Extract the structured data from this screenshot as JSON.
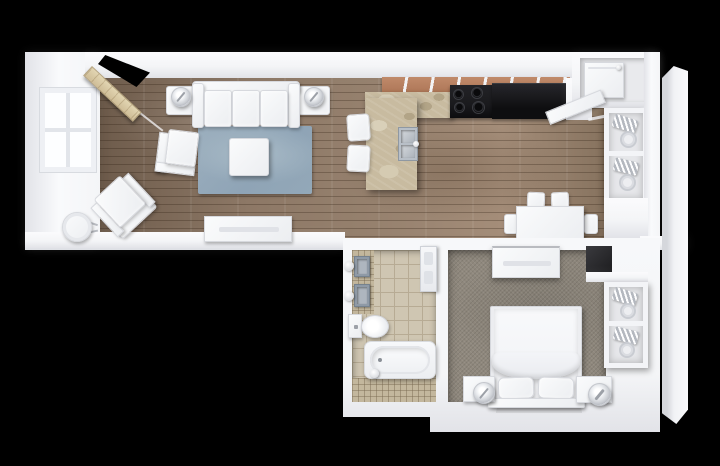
{
  "scene": {
    "type": "floor_plan_3d_render",
    "view": "top_down",
    "subject": "one-bedroom apartment with open living/kitchen/dining area, bathroom and bedroom",
    "background_color": "#000000"
  },
  "colors": {
    "background": "#000000",
    "wall": "#f4f5f7",
    "wall_shade": "#e2e3e8",
    "wood": "#8d7866",
    "wood_dark": "#6d5b4b",
    "wood_light": "#a48d79",
    "rug_blue": "#8fa4b6",
    "rug_blue_light": "#a9bbc7",
    "carpet": "#8f887d",
    "tile": "#cfc6b2",
    "grout": "#b7ab94",
    "mosaic": "#c3b79d",
    "granite": "#c8bba0",
    "granite_dark": "#b2a487",
    "cabinet_wood": "#b27b5c",
    "appliance": "#1a1a1d",
    "white_furniture": "#eceef1",
    "furniture_border": "#d7d9de",
    "steel": "#9aa3ad",
    "door_wood": "#cfbd97"
  },
  "rooms": [
    {
      "name": "living-room",
      "floor": "hardwood"
    },
    {
      "name": "kitchen",
      "floor": "hardwood"
    },
    {
      "name": "dining-area",
      "floor": "hardwood"
    },
    {
      "name": "bathroom",
      "floor": "tile"
    },
    {
      "name": "bedroom",
      "floor": "carpet"
    },
    {
      "name": "utility-closet",
      "contents": "water-heater"
    },
    {
      "name": "linen-closet",
      "contents": "wire-shelving"
    },
    {
      "name": "bedroom-closet",
      "contents": "wire-shelving"
    }
  ],
  "furniture": {
    "living_room": [
      "entry-door",
      "window",
      "sofa",
      "end-table",
      "table-lamp",
      "end-table",
      "table-lamp",
      "blue-area-rug",
      "coffee-table",
      "accent-chair",
      "armchair",
      "round-side-table",
      "tv-console"
    ],
    "kitchen": [
      "upper-cabinets",
      "granite-counter",
      "stove-cooktop",
      "dark-counter",
      "island-peninsula",
      "double-sink",
      "bar-stool",
      "bar-stool"
    ],
    "dining_area": [
      "dining-table",
      "dining-chair",
      "dining-chair",
      "dining-chair",
      "dining-chair"
    ],
    "bathroom": [
      "vessel-sink",
      "vessel-sink",
      "vanity-light",
      "vanity-light",
      "toilet",
      "bathtub",
      "door"
    ],
    "bedroom": [
      "dresser",
      "double-bed",
      "pillow",
      "pillow",
      "blanket",
      "nightstand",
      "table-lamp",
      "nightstand",
      "table-lamp",
      "rug"
    ]
  }
}
